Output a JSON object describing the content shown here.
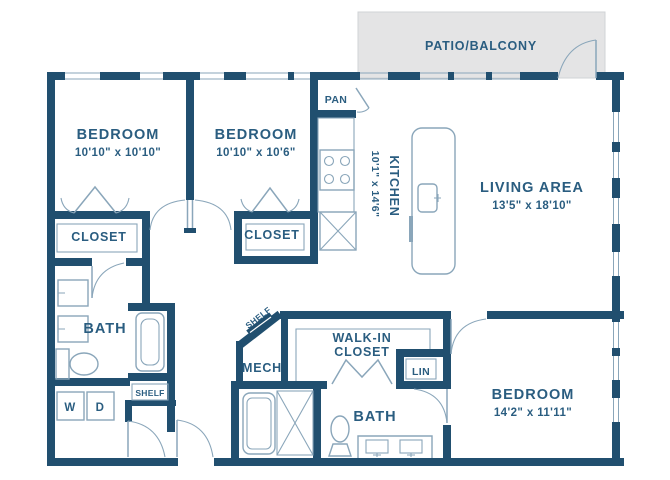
{
  "patio": {
    "label": "PATIO/BALCONY"
  },
  "rooms": {
    "bedroom1": {
      "label": "BEDROOM",
      "dims": "10'10\" x 10'10\""
    },
    "bedroom2": {
      "label": "BEDROOM",
      "dims": "10'10\" x 10'6\""
    },
    "bedroom3": {
      "label": "BEDROOM",
      "dims": "14'2\" x 11'11\""
    },
    "kitchen": {
      "label": "KITCHEN",
      "dims": "10'1\" x 14'6\""
    },
    "living_area": {
      "label": "LIVING AREA",
      "dims": "13'5\" x 18'10\""
    },
    "bath1": {
      "label": "BATH"
    },
    "bath2": {
      "label": "BATH"
    },
    "closet1": {
      "label": "CLOSET"
    },
    "closet2": {
      "label": "CLOSET"
    },
    "walk_in_closet": {
      "line1": "WALK-IN",
      "line2": "CLOSET"
    },
    "pantry": {
      "label": "PAN"
    },
    "mech": {
      "label": "MECH"
    },
    "linen": {
      "label": "LIN"
    },
    "shelf_hall": {
      "label": "SHELF"
    },
    "shelf_mech": {
      "label": "SHELF"
    },
    "laundry": {
      "washer": "W",
      "dryer": "D"
    }
  },
  "colors": {
    "wall": "#214f6f",
    "text": "#2a5d80",
    "fixture": "#8aa6ba",
    "patio_fill": "#e4e4e5",
    "patio_border": "#d0d3d6",
    "background": "#ffffff"
  }
}
